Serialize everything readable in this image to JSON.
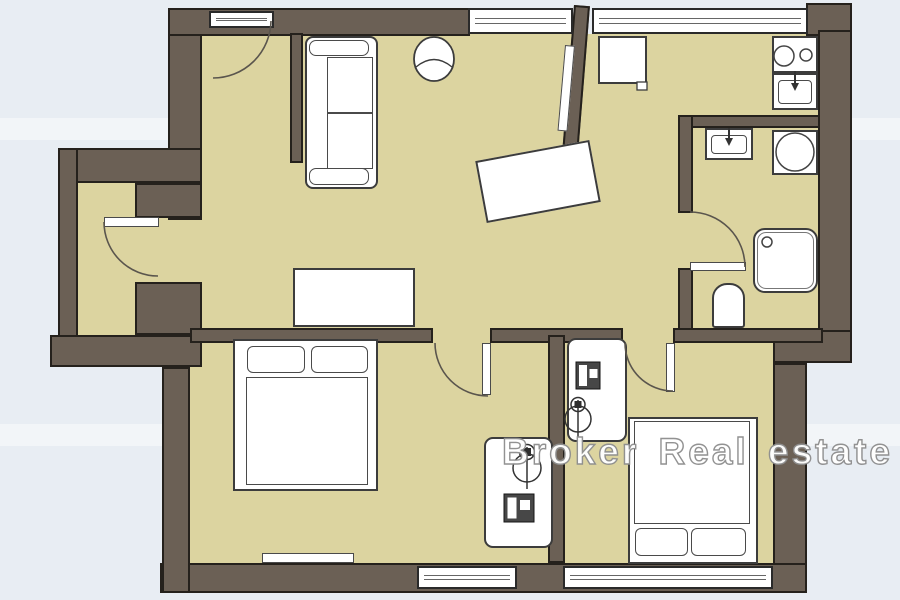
{
  "watermark": {
    "text": "Broker Real estate"
  },
  "palette": {
    "background": "#e8edf3",
    "background_band": "#f2f6fa",
    "wall": "#6b6055",
    "wall_outline": "#25211c",
    "floor": "#dcd4a0",
    "fixture_fill": "#ffffff",
    "fixture_line": "#3c3c3c",
    "door_arc": "#5a554d",
    "watermark_fill": "#ffffff",
    "watermark_outline": "#8f8f8f"
  },
  "plan": {
    "type": "apartment-floor-plan",
    "windows_count": 4,
    "doors_count": 6,
    "fixtures": [
      "sofa",
      "armchair",
      "dining-table",
      "sliding-door",
      "wardrobe",
      "kitchen-table",
      "stove",
      "kitchen-sink",
      "bathroom-sink",
      "washing-machine",
      "shower",
      "toilet",
      "double-bed",
      "single-bed",
      "desk",
      "office-chair",
      "computer",
      "radiator"
    ]
  }
}
